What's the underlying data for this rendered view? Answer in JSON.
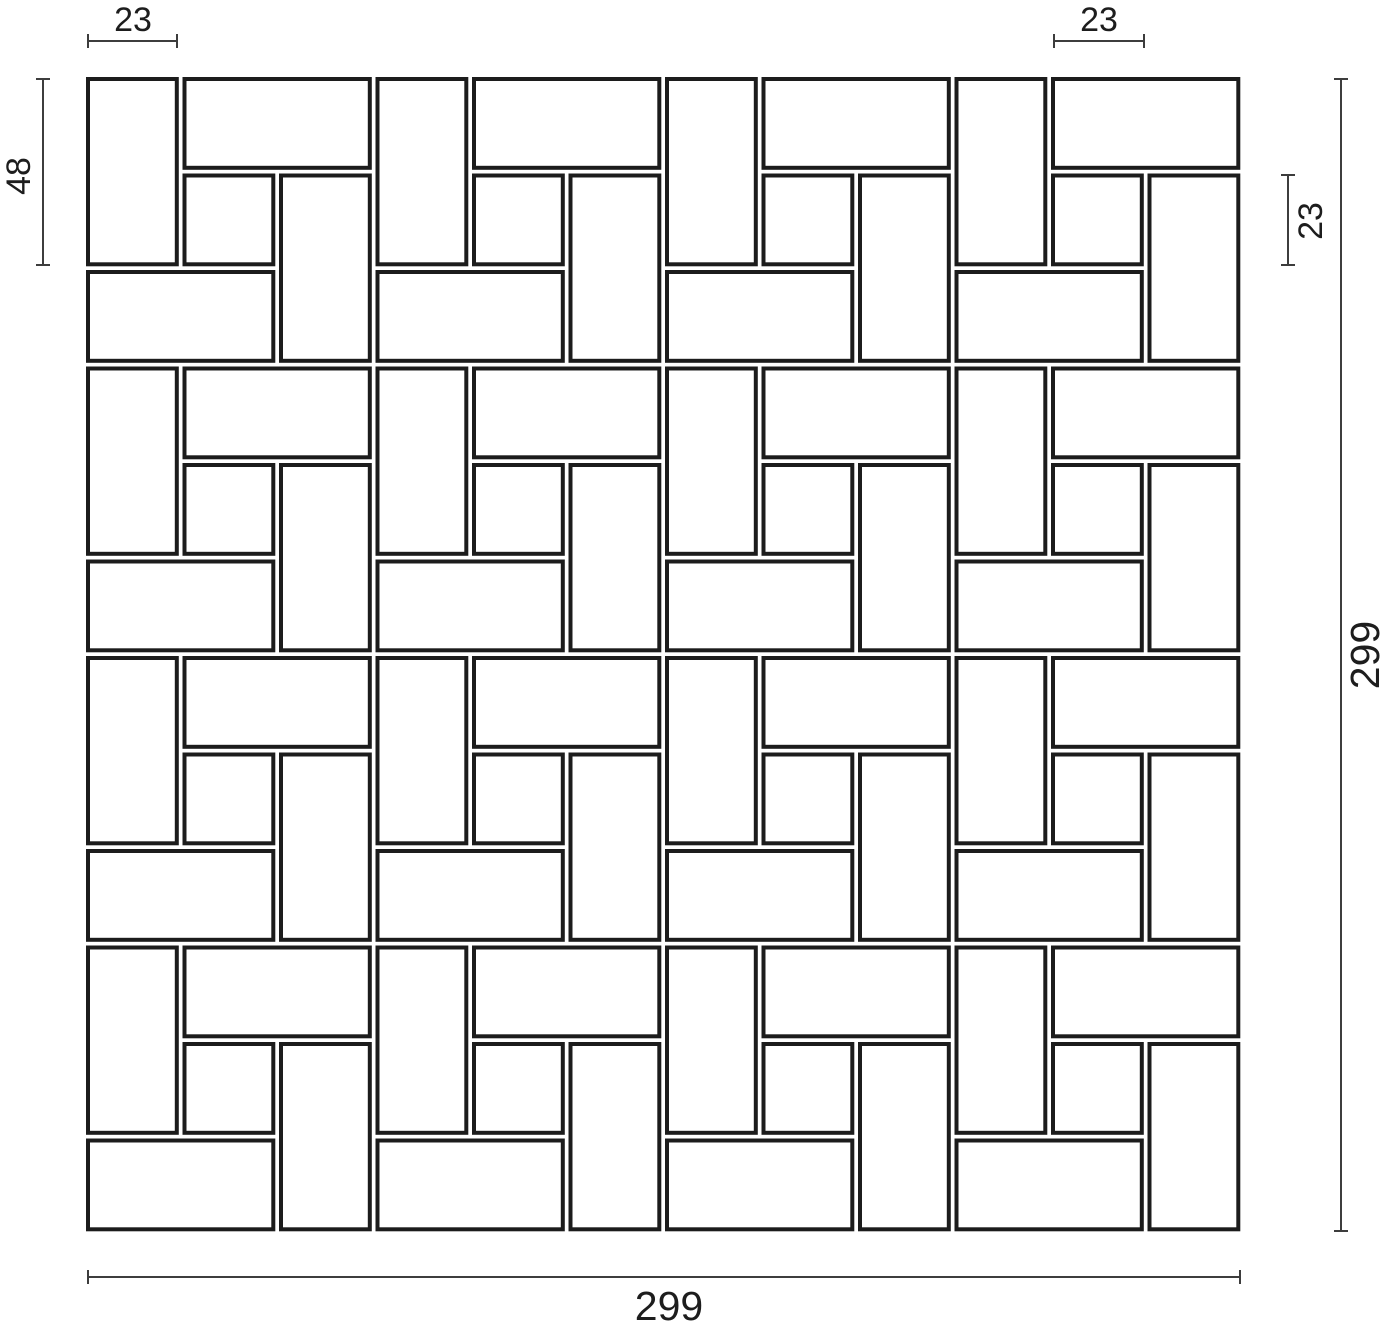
{
  "drawing": {
    "title": "Pinwheel tile pattern dimensioned drawing",
    "background": "#ffffff",
    "tile_fill": "#ffffff",
    "tile_stroke": "#1c1c1c",
    "tile_stroke_width": 4,
    "dim_line_color": "#3d3d3d",
    "dim_line_width": 2,
    "dim_tick_half_length": 7,
    "text_color": "#1d1d1d",
    "pattern": {
      "type": "pinwheel",
      "cols": 4,
      "rows": 4,
      "origin_x": 88,
      "origin_y": 79,
      "px_per_unit": 3.86,
      "unit_pitch_units": 75,
      "grout_units": 2,
      "rect_tile_units": {
        "w": 23,
        "h": 48
      },
      "square_tile_units": {
        "w": 23,
        "h": 23
      },
      "unit_tiles": [
        {
          "name": "vertical-left",
          "x": 0,
          "y": 0,
          "w": 23,
          "h": 48
        },
        {
          "name": "horizontal-top",
          "x": 25,
          "y": 0,
          "w": 48,
          "h": 23
        },
        {
          "name": "center-square",
          "x": 25,
          "y": 25,
          "w": 23,
          "h": 23
        },
        {
          "name": "vertical-right",
          "x": 50,
          "y": 25,
          "w": 23,
          "h": 48
        },
        {
          "name": "horizontal-bottom",
          "x": 0,
          "y": 50,
          "w": 48,
          "h": 23
        }
      ]
    },
    "dimensions": [
      {
        "id": "tile-width-top-left",
        "label": "23",
        "orient": "h",
        "x1": 88,
        "x2": 177,
        "line": 41,
        "lx": 133,
        "ly": 31,
        "fs": 34
      },
      {
        "id": "square-width-top-right",
        "label": "23",
        "orient": "h",
        "x1": 1054,
        "x2": 1144,
        "line": 41,
        "lx": 1099,
        "ly": 31,
        "fs": 34
      },
      {
        "id": "tile-height-left",
        "label": "48",
        "orient": "v",
        "y1": 79,
        "y2": 265,
        "line": 43,
        "lx": 19,
        "ly": 176,
        "fs": 34
      },
      {
        "id": "square-height-right",
        "label": "23",
        "orient": "v",
        "y1": 175,
        "y2": 265,
        "line": 1288,
        "lx": 1311,
        "ly": 221,
        "fs": 34
      },
      {
        "id": "overall-height-right",
        "label": "299",
        "orient": "v",
        "y1": 79,
        "y2": 1231,
        "line": 1341,
        "lx": 1365,
        "ly": 655,
        "fs": 41
      },
      {
        "id": "overall-width-bottom",
        "label": "299",
        "orient": "h",
        "x1": 88,
        "x2": 1240,
        "line": 1277,
        "lx": 669,
        "ly": 1320,
        "fs": 41
      }
    ]
  }
}
